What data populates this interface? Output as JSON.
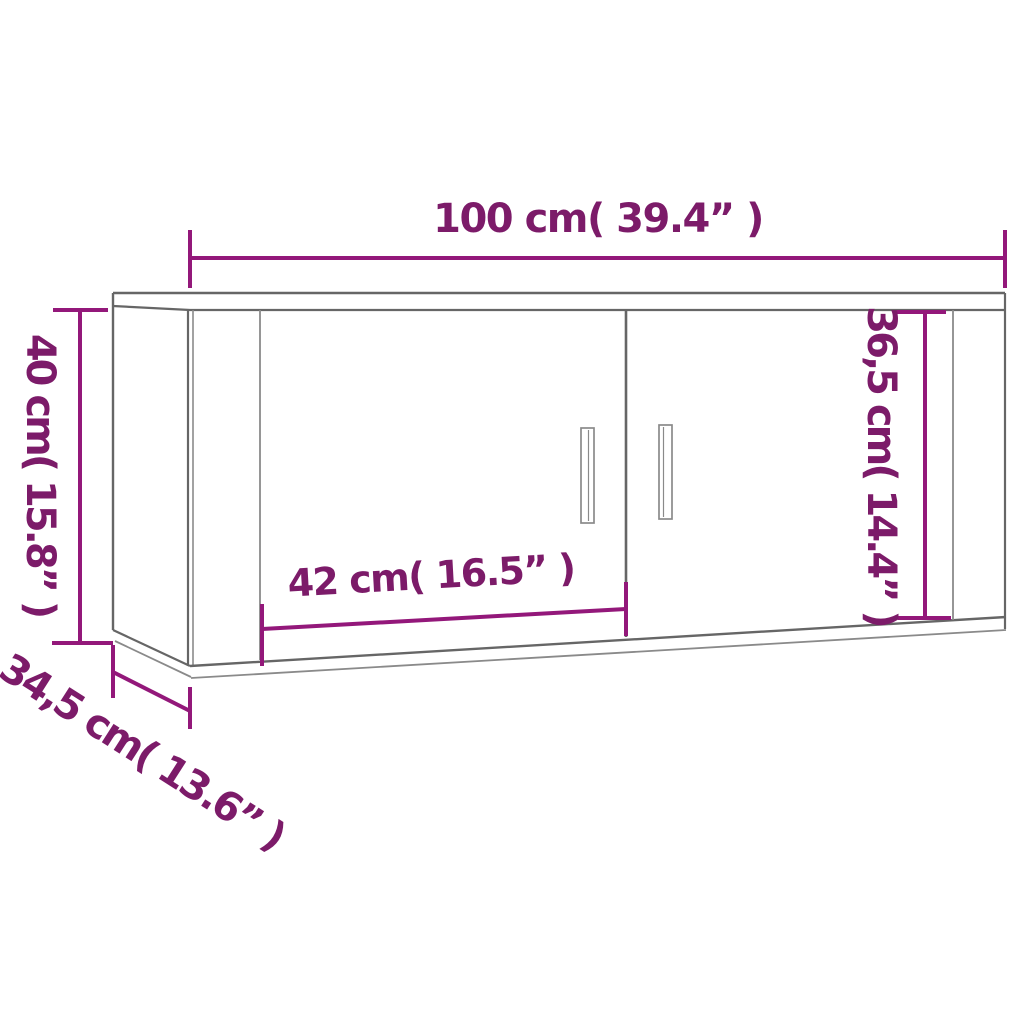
{
  "diagram": {
    "type": "furniture-dimension-drawing",
    "labels": {
      "width": "100 cm( 39.4” )",
      "height": "40 cm( 15.8” )",
      "door_height": "36,5 cm( 14.4” )",
      "door_width": "42 cm( 16.5” )",
      "depth": "34,5 cm( 13.6” )"
    },
    "colors": {
      "dimension": "#93187a",
      "dimension_text": "#7c1b69",
      "outline": "#666666",
      "outline_light": "#8a8a8a",
      "background": "#ffffff"
    }
  }
}
